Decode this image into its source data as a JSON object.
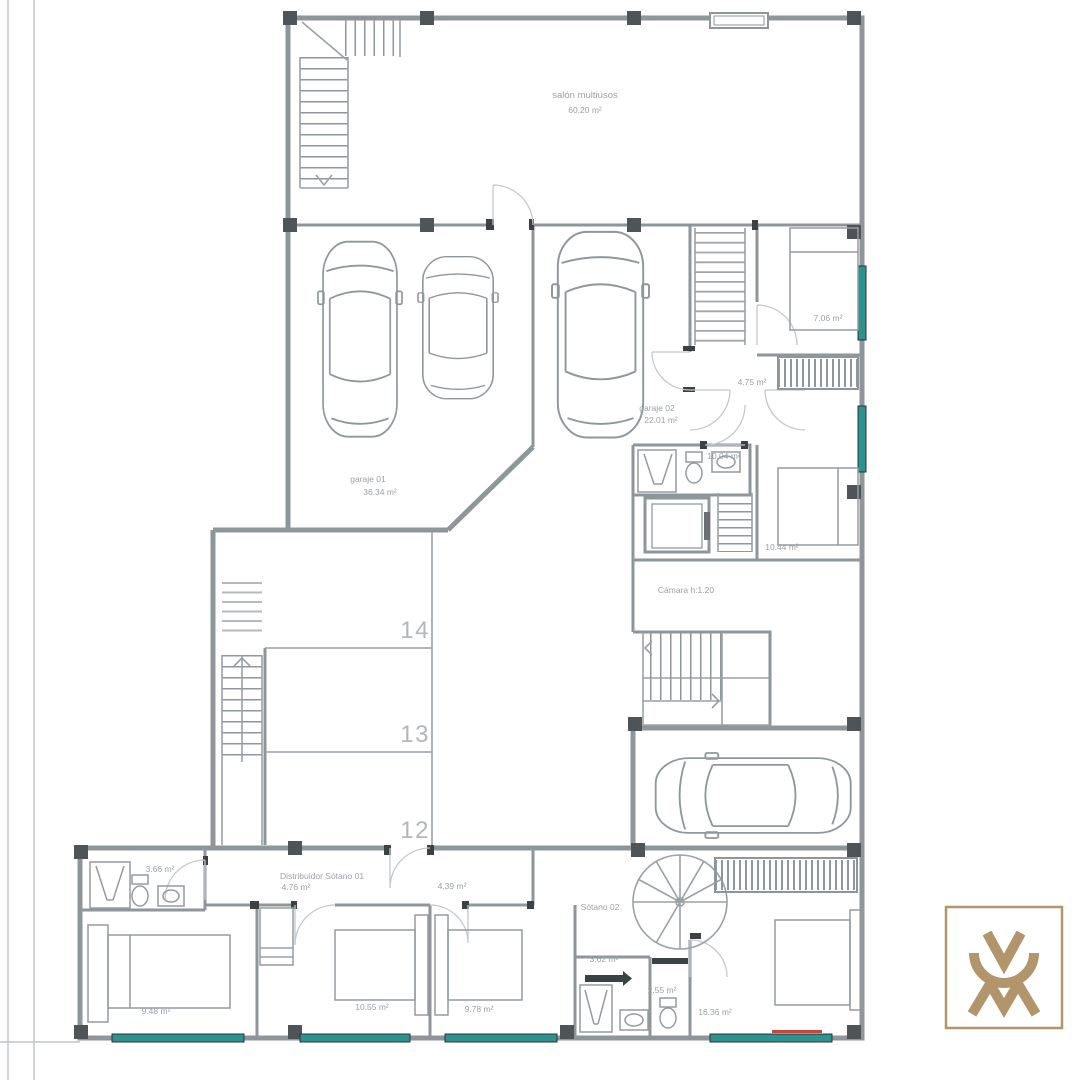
{
  "document_type": "basement floor plan drawing",
  "colors": {
    "wall_gray": "#8e969a",
    "column_dark": "#4e5457",
    "window_teal": "#2e938e",
    "accent_red": "#c9463d",
    "logo_gold": "#b3956c",
    "label_gray": "#9aa0a4"
  },
  "rooms": {
    "salon": {
      "name": "salón multiusos",
      "area": "60.20 m²"
    },
    "garaje1": {
      "name": "garaje 01",
      "area": "36.34 m²"
    },
    "garaje2": {
      "name": "garaje 02",
      "area": "22.01 m²"
    },
    "bedroom_top_right": {
      "area": "7.06 m²"
    },
    "hall_top_right": {
      "area": "4.75 m²"
    },
    "bath_top_right": {
      "area": "10.04 m²"
    },
    "room_right": {
      "area": "10.44 m²"
    },
    "camara": {
      "name": "Cámara h:1.20"
    },
    "distribuidor": {
      "name": "Distribuidor Sótano 01",
      "area": "4.76 m²"
    },
    "pasillo": {
      "area": "4.39 m²"
    },
    "sotano_02": {
      "name": "Sótano 02"
    },
    "bath_mid": {
      "area": "3.62 m²"
    },
    "wc": {
      "area": "2.55 m²"
    },
    "bath_left": {
      "area": "3.66 m²"
    },
    "bedroom_left": {
      "area": "9.48 m²"
    },
    "bedroom_mid_1": {
      "area": "10.55 m²"
    },
    "bedroom_mid_2": {
      "area": "9.78 m²"
    },
    "bedroom_right": {
      "area": "16.36 m²"
    }
  },
  "parking_spaces": [
    "14",
    "13",
    "12"
  ]
}
